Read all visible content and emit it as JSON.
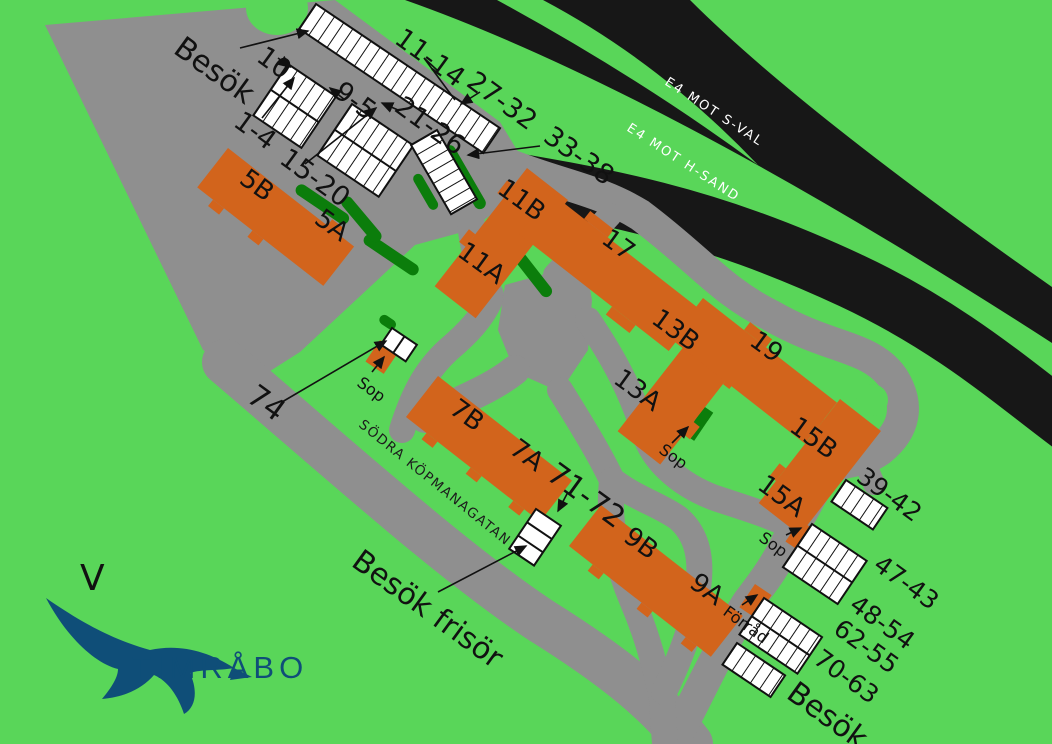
{
  "highways": {
    "upper_label": "E4  MOT S-VAL",
    "lower_label": "E4  MOT H-SAND"
  },
  "street_label": "SÖDRA KÖPMANAGATAN",
  "compass_letter": "V",
  "logo": {
    "text": "TIMRÅBO"
  },
  "buildings": {
    "b5B": "5B",
    "b5A": "5A",
    "b11B": "11B",
    "b11A": "11A",
    "b17": "17",
    "b13B": "13B",
    "b13A": "13A",
    "b19": "19",
    "b15B": "15B",
    "b15A": "15A",
    "b7B": "7B",
    "b7A": "7A",
    "b9B": "9B",
    "b9A": "9A"
  },
  "parking": {
    "besok_top": "Besök",
    "p10": "10",
    "p9_5": "9-5",
    "p1_4": "1-4",
    "p11_14": "11-14",
    "p27_32": "27-32",
    "p21_26": "21-26",
    "p15_20": "15-20",
    "p33_38": "33-38",
    "p74": "74",
    "p71_72": "71-72",
    "p39_42": "39-42",
    "p47_43": "47-43",
    "p48_54": "48-54",
    "p62_55": "62-55",
    "p70_63": "70-63",
    "besok_bottom": "Besök",
    "besok_frisor": "Besök frisör"
  },
  "facilities": {
    "sop_west": "Sop",
    "sop_mid": "Sop",
    "sop_east": "Sop",
    "forrad": "Förråd"
  },
  "colors": {
    "background": "#59d659",
    "road": "#8f8f8f",
    "building": "#d2641c",
    "hedge": "#0b7d0b",
    "highway": "#171717",
    "parking_fill": "#ffffff",
    "logo": "#0f4e78"
  }
}
